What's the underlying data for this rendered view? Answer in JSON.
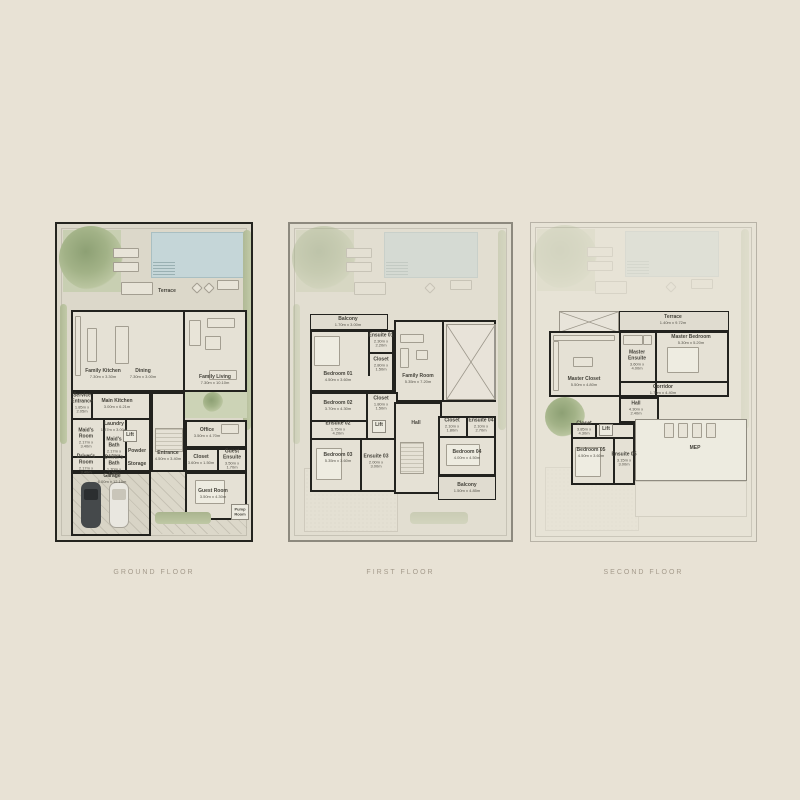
{
  "floors": [
    {
      "title": "GROUND FLOOR",
      "rooms": {
        "terrace": {
          "name": "Terrace"
        },
        "family_kitchen": {
          "name": "Family Kitchen",
          "dims": "7.30m x 3.30m"
        },
        "dining": {
          "name": "Dining",
          "dims": "7.30m x 3.00m"
        },
        "family_living": {
          "name": "Family Living",
          "dims": "7.30m x 10.10m"
        },
        "main_kitchen": {
          "name": "Main Kitchen",
          "dims": "3.00m x 6.21m"
        },
        "service_entrance": {
          "name": "Service Entrance",
          "dims": "1.85m x 2.05m"
        },
        "laundry": {
          "name": "Laundry",
          "dims": "1.87m x 3.00m"
        },
        "lift": {
          "name": "Lift"
        },
        "maids_room": {
          "name": "Maid's Room",
          "dims": "2.17m x 3.40m"
        },
        "maids_bath": {
          "name": "Maid's Bath",
          "dims": "2.17m x 1.50m"
        },
        "powder": {
          "name": "Powder"
        },
        "drivers_room": {
          "name": "Driver's Room",
          "dims": "2.17m x 3.40m"
        },
        "drivers_bath": {
          "name": "Driver's Bath",
          "dims": "1.70m x 1.50m"
        },
        "storage": {
          "name": "Storage"
        },
        "entrance": {
          "name": "Entrance",
          "dims": "4.50m x 3.40m"
        },
        "office": {
          "name": "Office",
          "dims": "3.50m x 4.70m"
        },
        "closet": {
          "name": "Closet",
          "dims": "3.60m x 1.50m"
        },
        "guest_ensuite": {
          "name": "Guest Ensuite",
          "dims": "3.50m x 1.70m"
        },
        "guest_room": {
          "name": "Guest Room",
          "dims": "3.50m x 4.30m"
        },
        "garage": {
          "name": "Garage",
          "dims": "6.00m x 12.10m"
        },
        "pump_room": {
          "name": "Pump Room"
        }
      }
    },
    {
      "title": "FIRST FLOOR",
      "rooms": {
        "balcony_front": {
          "name": "Balcony",
          "dims": "1.70m x 3.00m"
        },
        "bedroom_01": {
          "name": "Bedroom 01",
          "dims": "4.50m x 3.60m"
        },
        "ensuite_01": {
          "name": "Ensuite 01",
          "dims": "2.30m x 2.20m"
        },
        "closet_01": {
          "name": "Closet",
          "dims": "2.80m x 1.50m"
        },
        "family_room": {
          "name": "Family Room",
          "dims": "5.35m x 7.20m"
        },
        "bedroom_02": {
          "name": "Bedroom 02",
          "dims": "3.70m x 4.30m"
        },
        "closet_02": {
          "name": "Closet",
          "dims": "1.80m x 1.50m"
        },
        "ensuite_02": {
          "name": "Ensuite 02",
          "dims": "1.75m x 4.20m"
        },
        "lift": {
          "name": "Lift"
        },
        "hall": {
          "name": "Hall"
        },
        "bedroom_03": {
          "name": "Bedroom 03",
          "dims": "5.35m x 3.60m"
        },
        "ensuite_03": {
          "name": "Ensuite 03",
          "dims": "2.00m x 3.00m"
        },
        "closet_04": {
          "name": "Closet",
          "dims": "2.10m x 1.80m"
        },
        "ensuite_04": {
          "name": "Ensuite 04",
          "dims": "2.10m x 2.70m"
        },
        "bedroom_04": {
          "name": "Bedroom 04",
          "dims": "4.00m x 4.50m"
        },
        "balcony_rear": {
          "name": "Balcony",
          "dims": "1.50m x 4.85m"
        }
      }
    },
    {
      "title": "SECOND FLOOR",
      "rooms": {
        "terrace": {
          "name": "Terrace",
          "dims": "1.40m x 9.72m"
        },
        "master_bedroom": {
          "name": "Master Bedroom",
          "dims": "5.30m x 5.20m"
        },
        "master_ensuite": {
          "name": "Master Ensuite",
          "dims": "3.60m x 4.00m"
        },
        "master_closet": {
          "name": "Master Closet",
          "dims": "5.50m x 4.80m"
        },
        "corridor": {
          "name": "Corridor",
          "dims": "1.70m x 4.40m"
        },
        "hall": {
          "name": "Hall",
          "dims": "4.30m x 2.40m"
        },
        "closet": {
          "name": "Closet",
          "dims": "3.85m x 4.30m"
        },
        "lift": {
          "name": "Lift"
        },
        "bedroom_05": {
          "name": "Bedroom 05",
          "dims": "4.50m x 3.60m"
        },
        "ensuite_05": {
          "name": "Ensuite 05",
          "dims": "3.15m x 3.00m"
        },
        "mep": {
          "name": "MEP"
        }
      }
    }
  ]
}
